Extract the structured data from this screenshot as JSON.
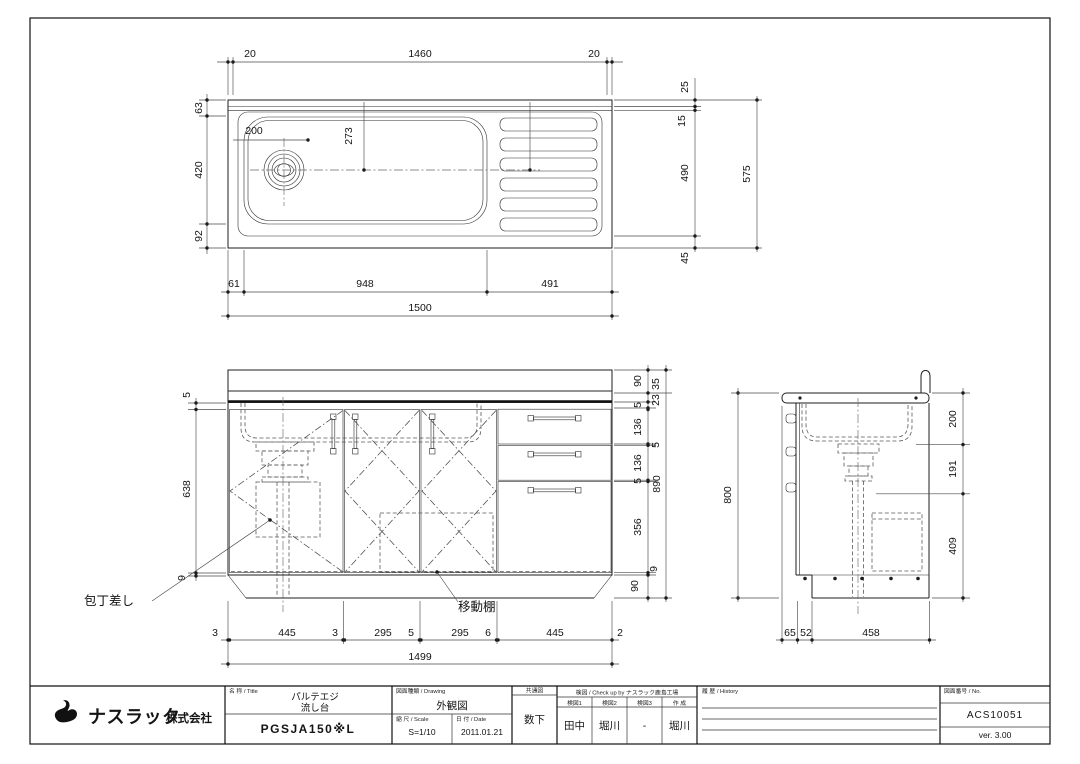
{
  "plan_view": {
    "top_dims": [
      "20",
      "1460",
      "20"
    ],
    "left_dims": [
      "63",
      "420",
      "92"
    ],
    "right_dims": [
      "25",
      "15",
      "490",
      "45"
    ],
    "right_total": "575",
    "bottom_dims": [
      "61",
      "948",
      "491"
    ],
    "bottom_total": "1500",
    "drain_x": "200",
    "drain_y": "273"
  },
  "front_view": {
    "left_dims": [
      "5",
      "638",
      "9"
    ],
    "right_dims": [
      "90",
      "35",
      "23",
      "5",
      "136",
      "5",
      "136",
      "5",
      "356",
      "9",
      "90"
    ],
    "right_total": "890",
    "height_total": "800",
    "bottom_dims": [
      "3",
      "445",
      "3",
      "295",
      "5",
      "295",
      "6",
      "445",
      "2"
    ],
    "bottom_total": "1499",
    "knife_label": "包丁差し",
    "shelf_label": "移動棚"
  },
  "side_view": {
    "right_dims": [
      "200",
      "191",
      "409"
    ],
    "bottom_dims": [
      "65",
      "52",
      "458"
    ]
  },
  "title_block": {
    "company_main": "ナスラック",
    "company_suffix": "株式会社",
    "name_header": "名 称 / Title",
    "product_line1": "パルテエジ",
    "product_line2": "流し台",
    "model": "PGSJA150※L",
    "drawing_header": "図面種類 / Drawing",
    "drawing_type": "外観図",
    "scale_header": "縮 尺 / Scale",
    "scale": "S=1/10",
    "date_header": "日 付 / Date",
    "date": "2011.01.21",
    "dist_header": "共通図",
    "dist_value": "数下",
    "check_header": "検図 / Check up by ナスラック鹿島工場",
    "check_cols": [
      {
        "label": "検図1",
        "value": "田中"
      },
      {
        "label": "検図2",
        "value": "堀川"
      },
      {
        "label": "検図3",
        "value": "-"
      },
      {
        "label": "作 成",
        "value": "堀川"
      }
    ],
    "history_header": "履 歴 / History",
    "no_header": "図面番号 / No.",
    "drawing_no": "ACS10051",
    "version": "ver. 3.00"
  }
}
